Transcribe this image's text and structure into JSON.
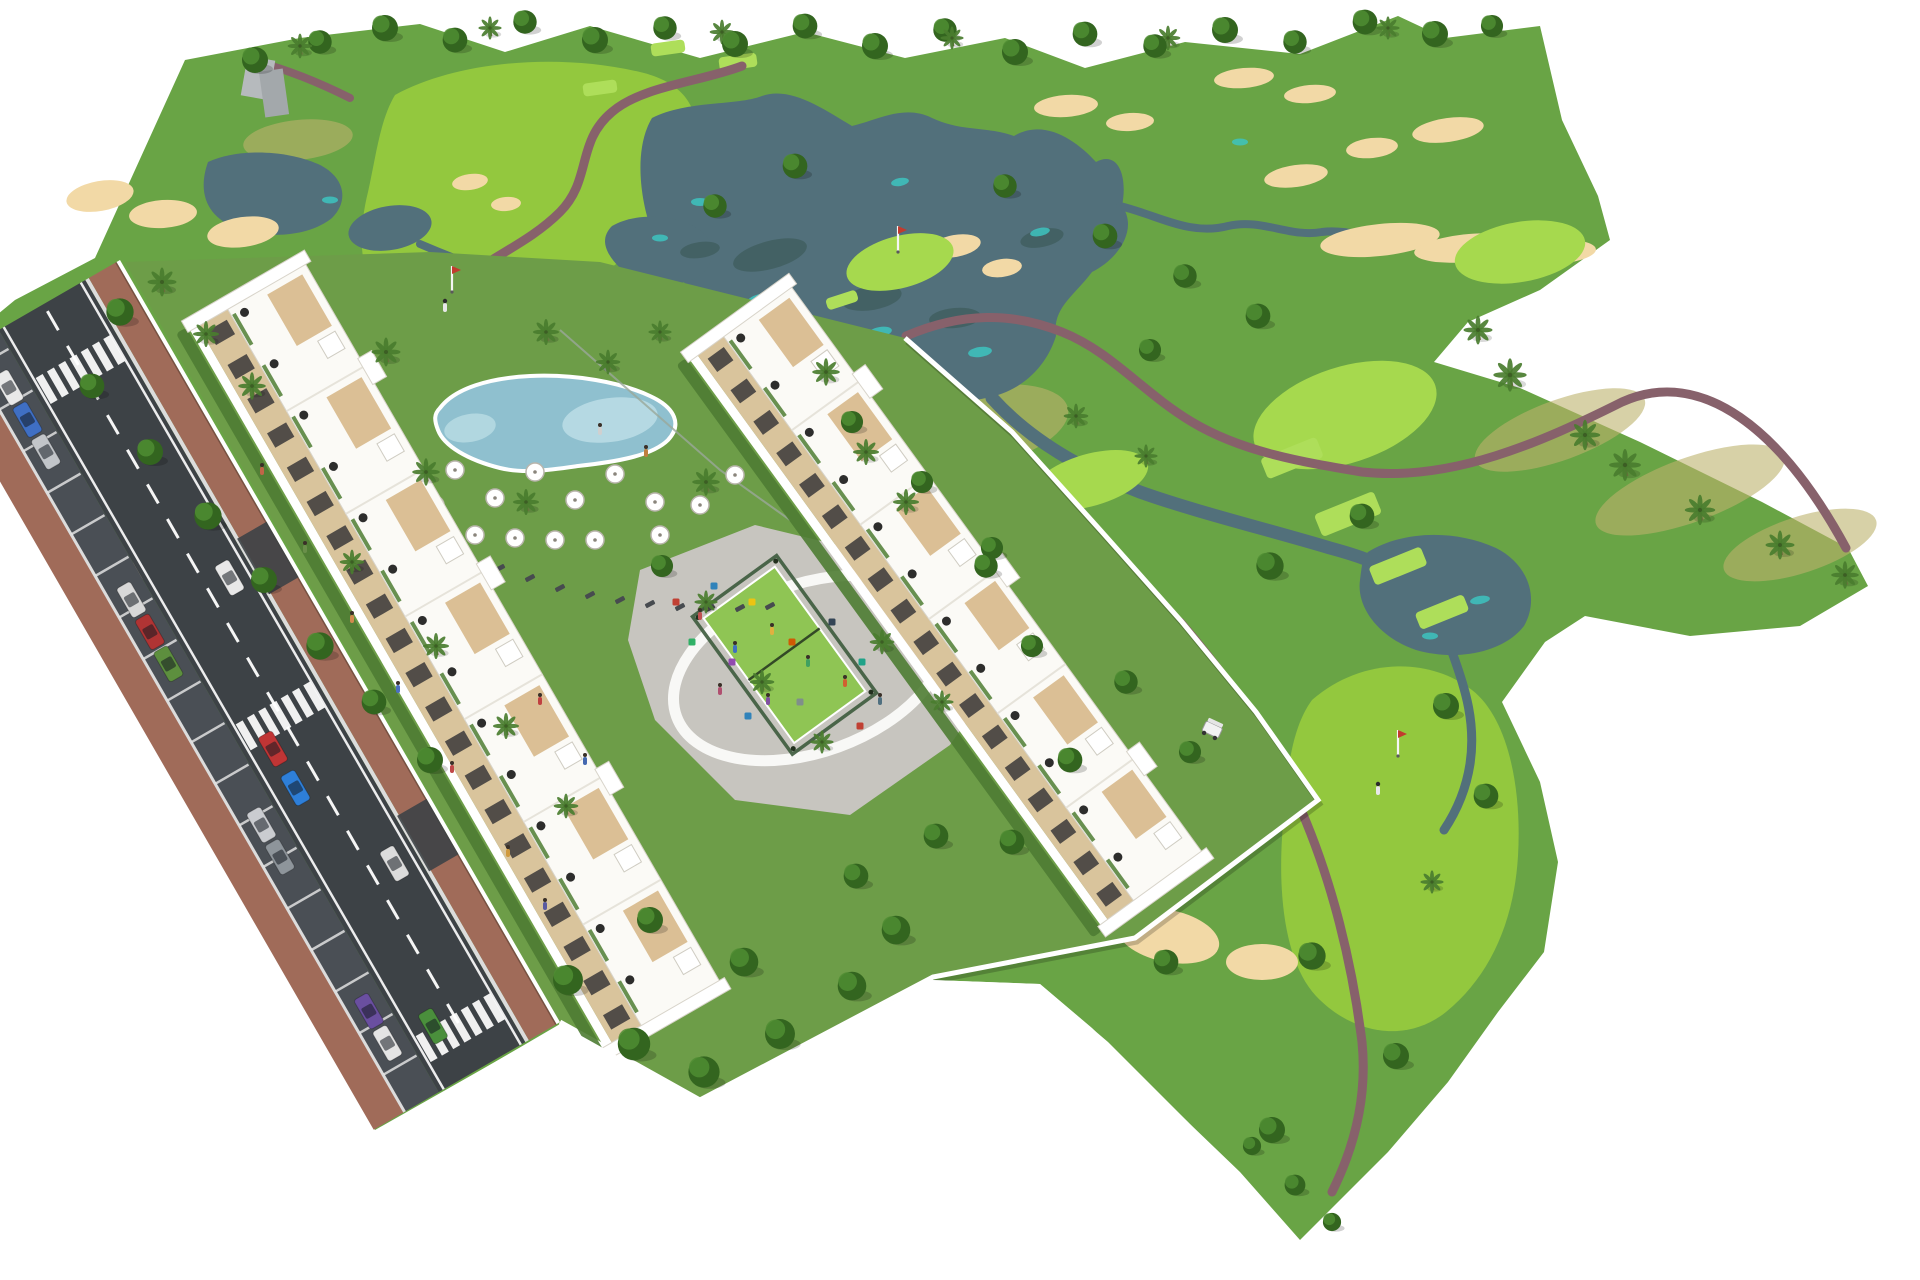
{
  "image": {
    "kind": "aerial-architectural-render",
    "subject": "golf resort apartment development beside golf course"
  },
  "colors": {
    "bg": "#ffffff",
    "base_grass": "#69a445",
    "parcel_lawn": "#6d9d48",
    "fairway": "#93c83e",
    "green_bright": "#a6d94e",
    "tee": "#aede5a",
    "water": "#52707b",
    "water_teal": "#3ec4c0",
    "reflection": "#35544e",
    "sand": "#f2d9a6",
    "path": "#87616b",
    "road": "#3d4246",
    "parking": "#4a4f55",
    "road_line": "#ffffff",
    "sidewalk": "#a06b59",
    "curb": "#dcdcdc",
    "wall": "#ffffff",
    "building_white": "#fbfaf6",
    "building_edge": "#d8d4ca",
    "facade_cream": "#d9c49c",
    "window_dark": "#2f2f33",
    "roof_tan": "#d9bc8f",
    "roof_dot": "#161616",
    "hedge": "#4e7c33",
    "padel_green": "#8fc554",
    "padel_fence": "#3c5a3c",
    "pool_water": "#8fc0cf",
    "pool_light": "#b9dce4",
    "plaza": "#c7c5bf",
    "plaza_ring": "#fbfbf9",
    "tree_dark": "#33651f",
    "tree_light": "#4f8d33",
    "palm": "#4a7d2f",
    "trunk": "#7d5f43",
    "scrub": "#bcb26d",
    "grey_structure": "#b6babd",
    "cart_body": "#f2f2f2",
    "lounger": "#474b4f"
  },
  "scene": {
    "buildings": [
      {
        "name": "apartment-row-west",
        "x": 190,
        "y": 330,
        "rot": 60,
        "len": 830,
        "roof_w": 90,
        "facade_h": 34,
        "units": 7
      },
      {
        "name": "apartment-row-east",
        "x": 690,
        "y": 360,
        "rot": 54,
        "len": 700,
        "roof_w": 84,
        "facade_h": 32,
        "units": 6
      }
    ],
    "road": {
      "length": 880,
      "dash_count": 21,
      "parking_sep_count": 18,
      "crosswalks": [
        60,
        460,
        820
      ],
      "driveways": [
        300,
        620
      ]
    },
    "cars_parked": [
      [
        55,
        "#e9e9e9"
      ],
      [
        92,
        "#3f6fc4"
      ],
      [
        129,
        "#c2c5c9"
      ],
      [
        300,
        "#d8d8d8"
      ],
      [
        337,
        "#b03434"
      ],
      [
        374,
        "#5d8f3e"
      ],
      [
        560,
        "#caccd0"
      ],
      [
        597,
        "#8e959b"
      ],
      [
        775,
        "#6a4fa0"
      ],
      [
        812,
        "#e4e4e4"
      ]
    ],
    "cars_moving": [
      [
        330,
        0,
        "#e8e8e8"
      ],
      [
        500,
        1,
        "#c03535"
      ],
      [
        545,
        1,
        "#2e7fd9"
      ],
      [
        660,
        0,
        "#dcdcdc"
      ],
      [
        820,
        1,
        "#4a8f3c"
      ]
    ],
    "bunkers": [
      [
        100,
        196,
        34,
        15,
        -10
      ],
      [
        163,
        214,
        34,
        14,
        -4
      ],
      [
        243,
        232,
        36,
        15,
        -8
      ],
      [
        62,
        556,
        26,
        11,
        -8
      ],
      [
        118,
        574,
        30,
        12,
        -5
      ],
      [
        88,
        598,
        22,
        9,
        0
      ],
      [
        470,
        182,
        18,
        8,
        -8
      ],
      [
        506,
        204,
        15,
        7,
        -5
      ],
      [
        955,
        246,
        26,
        11,
        -10
      ],
      [
        1002,
        268,
        20,
        9,
        -8
      ],
      [
        1066,
        106,
        32,
        11,
        -4
      ],
      [
        1130,
        122,
        24,
        9,
        -4
      ],
      [
        1244,
        78,
        30,
        10,
        -5
      ],
      [
        1310,
        94,
        26,
        9,
        -5
      ],
      [
        1372,
        148,
        26,
        10,
        -6
      ],
      [
        1296,
        176,
        32,
        11,
        -8
      ],
      [
        1380,
        240,
        60,
        16,
        -6
      ],
      [
        1470,
        248,
        56,
        14,
        -5
      ],
      [
        1556,
        252,
        40,
        12,
        -4
      ],
      [
        1448,
        130,
        36,
        12,
        -8
      ],
      [
        1150,
        740,
        52,
        26,
        -18
      ],
      [
        1212,
        792,
        42,
        22,
        16
      ],
      [
        1080,
        878,
        62,
        30,
        -10
      ],
      [
        1168,
        936,
        52,
        26,
        12
      ],
      [
        1262,
        962,
        36,
        18,
        0
      ],
      [
        1040,
        806,
        36,
        18,
        -8
      ]
    ],
    "greens": [
      [
        452,
        298,
        46,
        20,
        -14
      ],
      [
        1345,
        415,
        95,
        48,
        -18
      ],
      [
        1520,
        252,
        66,
        30,
        -10
      ],
      [
        900,
        262,
        55,
        26,
        -15
      ],
      [
        1090,
        480,
        60,
        26,
        -16
      ]
    ],
    "tee_boxes": [
      [
        1292,
        458,
        60,
        22,
        -22
      ],
      [
        1348,
        514,
        64,
        24,
        -22
      ],
      [
        1398,
        566,
        56,
        20,
        -22
      ],
      [
        1442,
        612,
        52,
        18,
        -22
      ],
      [
        668,
        48,
        34,
        13,
        -8
      ],
      [
        738,
        62,
        38,
        14,
        -8
      ],
      [
        842,
        300,
        32,
        12,
        -18
      ],
      [
        600,
        88,
        34,
        13,
        -8
      ]
    ],
    "lake_accents": [
      [
        760,
        300,
        14,
        6,
        -15
      ],
      [
        880,
        332,
        12,
        5,
        -10
      ],
      [
        980,
        352,
        12,
        5,
        -8
      ],
      [
        1040,
        232,
        10,
        4,
        -12
      ],
      [
        900,
        182,
        9,
        4,
        -10
      ],
      [
        700,
        202,
        9,
        4,
        0
      ],
      [
        1480,
        600,
        10,
        4,
        -10
      ],
      [
        1430,
        636,
        8,
        3.5,
        0
      ],
      [
        330,
        200,
        8,
        3.5,
        0
      ],
      [
        660,
        238,
        8,
        3.5,
        0
      ],
      [
        1240,
        142,
        8,
        3.5,
        0
      ]
    ],
    "lake_reflections": [
      [
        770,
        255,
        38,
        14,
        -15
      ],
      [
        872,
        298,
        30,
        12,
        -10
      ],
      [
        955,
        318,
        26,
        10,
        -5
      ],
      [
        1042,
        238,
        22,
        9,
        -12
      ],
      [
        700,
        250,
        20,
        8,
        -8
      ]
    ],
    "scrub_patches": [
      [
        975,
        428,
        95,
        40,
        -12
      ],
      [
        1560,
        430,
        90,
        30,
        -20
      ],
      [
        1690,
        490,
        100,
        32,
        -20
      ],
      [
        1800,
        545,
        80,
        28,
        -18
      ],
      [
        935,
        470,
        70,
        28,
        -14
      ],
      [
        298,
        140,
        55,
        20,
        -6
      ]
    ],
    "trees": [
      [
        255,
        60,
        1
      ],
      [
        320,
        42,
        0.9
      ],
      [
        385,
        28,
        1
      ],
      [
        455,
        40,
        0.95
      ],
      [
        525,
        22,
        0.9
      ],
      [
        595,
        40,
        1
      ],
      [
        665,
        28,
        0.9
      ],
      [
        735,
        44,
        1
      ],
      [
        805,
        26,
        0.95
      ],
      [
        875,
        46,
        1
      ],
      [
        945,
        30,
        0.9
      ],
      [
        1015,
        52,
        1
      ],
      [
        1085,
        34,
        0.95
      ],
      [
        1155,
        46,
        0.9
      ],
      [
        1225,
        30,
        1
      ],
      [
        1295,
        42,
        0.9
      ],
      [
        1365,
        22,
        0.95
      ],
      [
        1435,
        34,
        1
      ],
      [
        1492,
        26,
        0.85
      ],
      [
        120,
        312,
        1.05
      ],
      [
        92,
        386,
        0.95
      ],
      [
        150,
        452,
        1
      ],
      [
        208,
        516,
        1.05
      ],
      [
        264,
        580,
        1
      ],
      [
        320,
        646,
        1.05
      ],
      [
        374,
        702,
        0.95
      ],
      [
        430,
        760,
        1
      ],
      [
        715,
        206,
        0.9
      ],
      [
        795,
        166,
        0.95
      ],
      [
        1005,
        186,
        0.9
      ],
      [
        1105,
        236,
        0.95
      ],
      [
        1185,
        276,
        0.9
      ],
      [
        1258,
        316,
        0.95
      ],
      [
        1150,
        350,
        0.85
      ],
      [
        1270,
        566,
        1.05
      ],
      [
        1362,
        516,
        0.95
      ],
      [
        1446,
        706,
        1
      ],
      [
        1486,
        796,
        0.95
      ],
      [
        1312,
        956,
        1.05
      ],
      [
        1396,
        1056,
        1
      ],
      [
        1272,
        1130,
        1
      ],
      [
        1166,
        962,
        0.95
      ],
      [
        1295,
        1185,
        0.8
      ],
      [
        1332,
        1222,
        0.7
      ],
      [
        1252,
        1146,
        0.7
      ],
      [
        568,
        980,
        1.15
      ],
      [
        634,
        1044,
        1.25
      ],
      [
        704,
        1072,
        1.2
      ],
      [
        780,
        1034,
        1.15
      ],
      [
        852,
        986,
        1.1
      ],
      [
        896,
        930,
        1.1
      ],
      [
        744,
        962,
        1.1
      ],
      [
        650,
        920,
        1.0
      ],
      [
        936,
        836,
        0.95
      ],
      [
        856,
        876,
        0.95
      ],
      [
        662,
        566,
        0.85
      ],
      [
        986,
        566,
        0.9
      ],
      [
        1032,
        646,
        0.85
      ],
      [
        1070,
        760,
        0.95
      ],
      [
        1012,
        842,
        0.95
      ],
      [
        852,
        422,
        0.85
      ],
      [
        922,
        482,
        0.85
      ],
      [
        992,
        548,
        0.85
      ],
      [
        1126,
        682,
        0.9
      ],
      [
        1190,
        752,
        0.85
      ]
    ],
    "palms": [
      [
        162,
        282,
        1
      ],
      [
        206,
        334,
        0.9
      ],
      [
        252,
        386,
        0.95
      ],
      [
        386,
        352,
        1
      ],
      [
        426,
        472,
        0.95
      ],
      [
        526,
        502,
        0.9
      ],
      [
        706,
        482,
        0.95
      ],
      [
        826,
        372,
        0.95
      ],
      [
        866,
        452,
        0.9
      ],
      [
        546,
        332,
        0.9
      ],
      [
        906,
        502,
        0.9
      ],
      [
        706,
        602,
        0.8
      ],
      [
        762,
        682,
        0.85
      ],
      [
        822,
        742,
        0.8
      ],
      [
        882,
        642,
        0.85
      ],
      [
        942,
        702,
        0.8
      ],
      [
        436,
        646,
        0.9
      ],
      [
        506,
        726,
        0.9
      ],
      [
        566,
        806,
        0.85
      ],
      [
        352,
        562,
        0.85
      ],
      [
        300,
        46,
        0.85
      ],
      [
        490,
        28,
        0.8
      ],
      [
        722,
        32,
        0.85
      ],
      [
        952,
        38,
        0.8
      ],
      [
        1168,
        38,
        0.85
      ],
      [
        1388,
        28,
        0.8
      ],
      [
        1478,
        330,
        1.0
      ],
      [
        1510,
        375,
        1.15
      ],
      [
        1585,
        435,
        1.05
      ],
      [
        1625,
        465,
        1.1
      ],
      [
        1700,
        510,
        1.05
      ],
      [
        1780,
        545,
        1.0
      ],
      [
        1845,
        575,
        0.95
      ],
      [
        1076,
        416,
        0.85
      ],
      [
        1146,
        456,
        0.8
      ],
      [
        1432,
        882,
        0.8
      ],
      [
        608,
        362,
        0.85
      ],
      [
        660,
        332,
        0.8
      ]
    ],
    "parasols": [
      [
        455,
        470
      ],
      [
        495,
        498
      ],
      [
        535,
        472
      ],
      [
        575,
        500
      ],
      [
        615,
        474
      ],
      [
        655,
        502
      ],
      [
        435,
        505
      ],
      [
        475,
        535
      ],
      [
        515,
        538
      ],
      [
        555,
        540
      ],
      [
        595,
        540
      ],
      [
        660,
        535
      ],
      [
        700,
        505
      ],
      [
        735,
        475
      ]
    ],
    "loungers": [
      [
        440,
        548
      ],
      [
        470,
        558
      ],
      [
        500,
        568
      ],
      [
        530,
        578
      ],
      [
        560,
        588
      ],
      [
        590,
        595
      ],
      [
        620,
        600
      ],
      [
        650,
        604
      ],
      [
        680,
        607
      ],
      [
        710,
        608
      ],
      [
        740,
        608
      ],
      [
        770,
        606
      ]
    ],
    "playground_items": [
      [
        676,
        602,
        "#c0392b"
      ],
      [
        714,
        586,
        "#2980b9"
      ],
      [
        752,
        602,
        "#f1c40f"
      ],
      [
        692,
        642,
        "#27ae60"
      ],
      [
        732,
        662,
        "#8e44ad"
      ],
      [
        792,
        642,
        "#d35400"
      ],
      [
        832,
        622,
        "#2c3e50"
      ],
      [
        862,
        662,
        "#16a085"
      ],
      [
        900,
        642,
        "#c0392b"
      ],
      [
        800,
        702,
        "#7f8c8d"
      ],
      [
        748,
        716,
        "#2980b9"
      ],
      [
        860,
        726,
        "#c0392b"
      ]
    ],
    "people": [
      [
        262,
        470,
        "#c06548"
      ],
      [
        305,
        548,
        "#6a8f4a"
      ],
      [
        352,
        618,
        "#d08a4e"
      ],
      [
        398,
        688,
        "#4a6fc0"
      ],
      [
        452,
        768,
        "#c04848"
      ],
      [
        508,
        852,
        "#d09a3e"
      ],
      [
        545,
        905,
        "#5a5aa0"
      ],
      [
        540,
        700,
        "#c04040"
      ],
      [
        585,
        760,
        "#4468b0"
      ],
      [
        700,
        615,
        "#c05050"
      ],
      [
        735,
        648,
        "#4070c0"
      ],
      [
        772,
        630,
        "#e0b040"
      ],
      [
        808,
        662,
        "#40a060"
      ],
      [
        768,
        700,
        "#8050a0"
      ],
      [
        845,
        682,
        "#d06030"
      ],
      [
        880,
        700,
        "#507080"
      ],
      [
        720,
        690,
        "#b05070"
      ],
      [
        600,
        430,
        "#d0d0d0"
      ],
      [
        646,
        452,
        "#c08040"
      ]
    ],
    "flags": [
      [
        452,
        292
      ],
      [
        1398,
        756
      ],
      [
        898,
        252
      ]
    ],
    "golfers": [
      [
        445,
        307
      ],
      [
        1378,
        790
      ]
    ],
    "golf_cart": {
      "x": 1212,
      "y": 730,
      "rot": 25
    }
  }
}
